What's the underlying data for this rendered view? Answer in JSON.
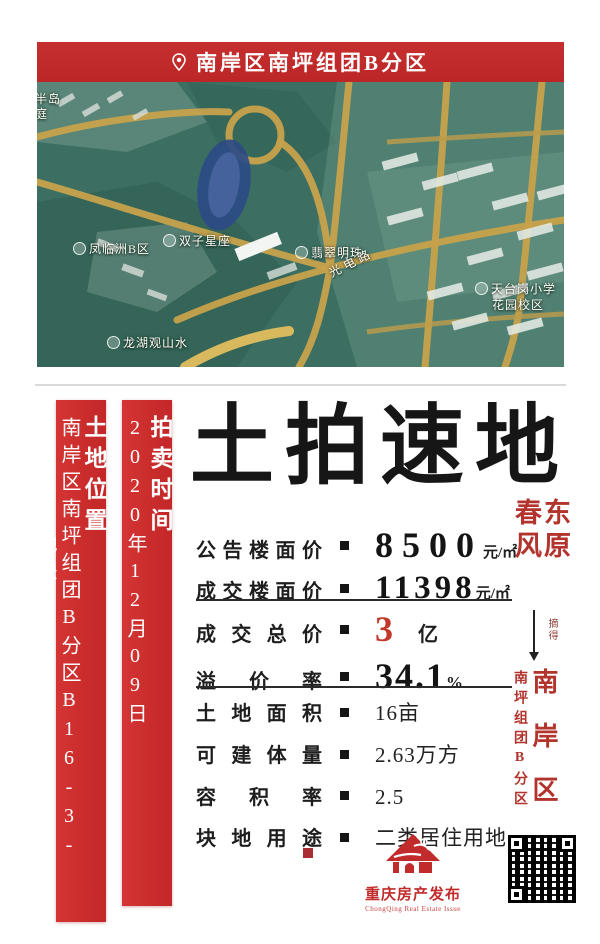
{
  "header": {
    "location": "南岸区南坪组团B分区"
  },
  "map_labels": {
    "partial_top1": "半岛",
    "partial_top2": "庭",
    "fenglinzhou": "凤临洲B区",
    "shuangzi": "双子星座",
    "feicui": "翡翠明珠",
    "road": "光电路",
    "school_line1": "天台岗小学",
    "school_line2": "花园校区",
    "longhu": "龙湖观山水"
  },
  "left_bars": {
    "bar1_title": "土地位置",
    "bar1_value": "南岸区南坪组团B分区B16-3-1/05地块",
    "bar2_title": "拍卖时间",
    "bar2_value": "2020年12月09日"
  },
  "main": {
    "title": "土拍速地",
    "rows_price": [
      {
        "label": "公告楼面价",
        "value": "8500",
        "unit": "元/㎡"
      },
      {
        "label": "成交楼面价",
        "value": "11398",
        "unit": "元/㎡"
      }
    ],
    "rows_deal": [
      {
        "label": "成交总价",
        "value": "3",
        "unit": "亿"
      },
      {
        "label": "溢价率",
        "value": "34.1",
        "unit": "%"
      }
    ],
    "rows_detail": [
      {
        "label": "土地面积",
        "value": "16亩"
      },
      {
        "label": "可建体量",
        "value": "2.63万方"
      },
      {
        "label": "容积率",
        "value": "2.5"
      },
      {
        "label": "块地用途",
        "value": "二类居住用地"
      }
    ]
  },
  "right_col": {
    "buyer_right": "东原",
    "buyer_left": "春风",
    "arrow_label": "摘得",
    "district_main": "南岸区",
    "district_sub": "南坪组团B分区"
  },
  "footer": {
    "brand": "重庆房产发布",
    "brand_en": "ChongQing Real Estate Issue"
  },
  "colors": {
    "banner_red": "#c62f2f",
    "bar_red": "#cf2f2f",
    "accent_red": "#b2342d",
    "value_red": "#c0392b",
    "ink": "#161616"
  }
}
